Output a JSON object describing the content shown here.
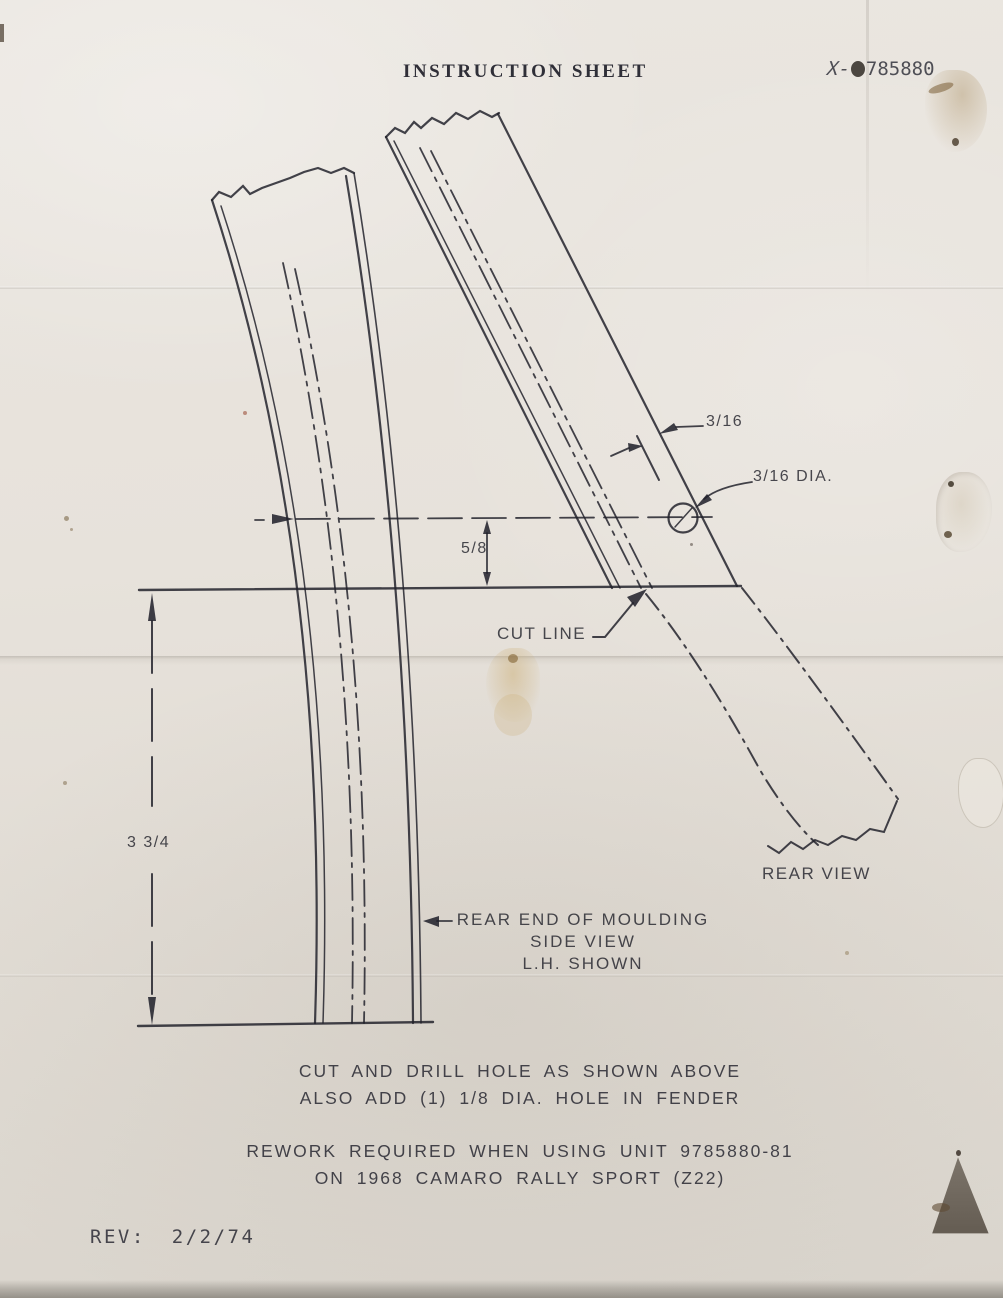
{
  "page": {
    "title": "INSTRUCTION SHEET",
    "part_number": {
      "prefix": "X-",
      "obscured_digit": "9",
      "rest": "785880"
    }
  },
  "diagram": {
    "labels": {
      "dim_edge_offset": "3/16",
      "dim_hole_diameter": "3/16 DIA.",
      "dim_hole_height": "5/8",
      "dim_length": "3 3/4",
      "cut_line": "CUT LINE",
      "rear_view": "REAR VIEW",
      "side_view_line1": "REAR END OF MOULDING",
      "side_view_line2": "SIDE VIEW",
      "side_view_line3": "L.H. SHOWN"
    }
  },
  "notes": {
    "instruction_line1": "CUT AND DRILL HOLE AS SHOWN ABOVE",
    "instruction_line2": "ALSO ADD (1) 1/8 DIA. HOLE IN FENDER",
    "rework_line1": "REWORK REQUIRED WHEN USING UNIT 9785880-81",
    "rework_line2": "ON 1968 CAMARO RALLY SPORT (Z22)"
  },
  "footer": {
    "rev_label": "REV:",
    "rev_date": "2/2/74"
  },
  "colors": {
    "paper": "#e7e2db",
    "ink": "#2b2b33",
    "stain": "#c9a96a"
  }
}
